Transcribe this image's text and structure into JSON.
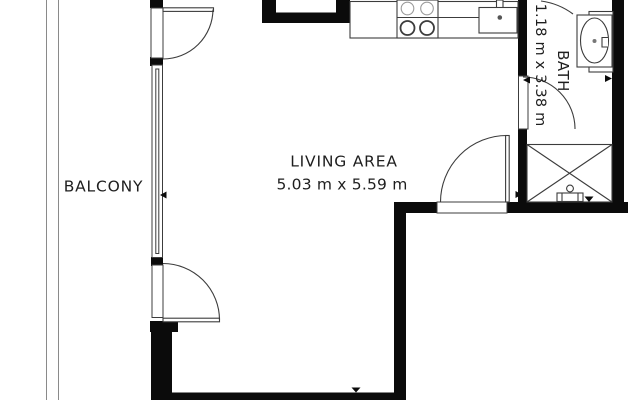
{
  "colors": {
    "wall": "#0b0b0b",
    "line": "#3c3c3c",
    "light_line": "#9b9b9b",
    "railing": "#8a8a8a",
    "background": "#ffffff",
    "text": "#1e1e1e"
  },
  "rooms": {
    "balcony": {
      "label": "BALCONY"
    },
    "living": {
      "label": "LIVING AREA",
      "dimensions": "5.03 m x 5.59 m"
    },
    "bath": {
      "label": "BATH",
      "dimensions": "1.18 m x 3.38 m"
    }
  },
  "fixtures": [
    "stove-burners-icon",
    "kitchen-sink-icon",
    "bath-sink-icon",
    "shower-icon",
    "shower-drain-icon",
    "window-glazing-icon",
    "door-swing-icon",
    "balcony-railing-icon",
    "arrow-marker-icon"
  ]
}
